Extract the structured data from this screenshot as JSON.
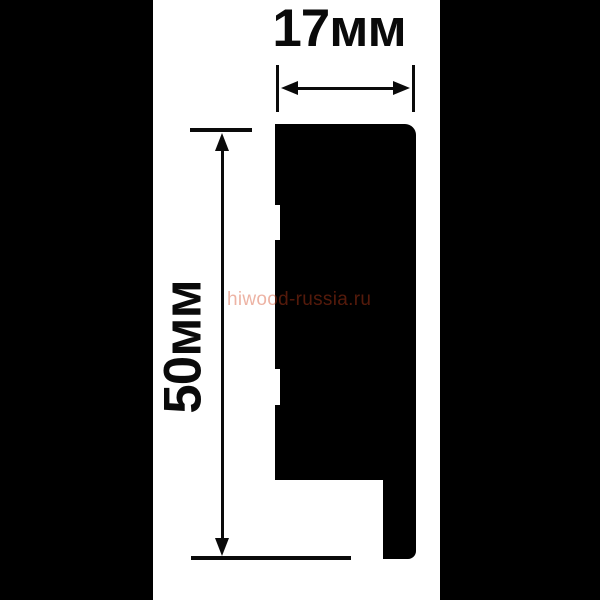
{
  "diagram": {
    "type": "molding-profile-cross-section-drawing",
    "dimensions": {
      "width_label": "17мм",
      "height_label": "50мм"
    },
    "watermark": {
      "text": "hiwood-russia.ru",
      "color": "#d1401b"
    },
    "colors": {
      "background": "#ffffff",
      "profile_fill": "#000000",
      "crop_bands": "#000000",
      "dimension_lines": "#0a0a0a"
    }
  }
}
